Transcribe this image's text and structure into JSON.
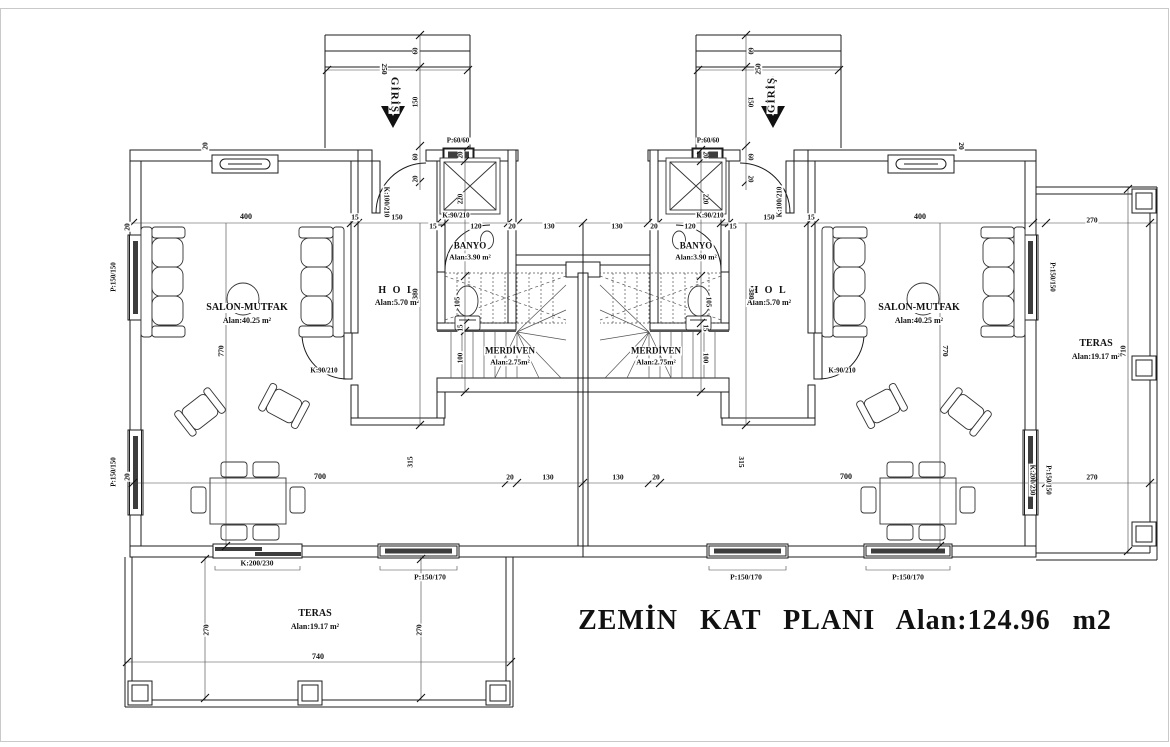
{
  "colors": {
    "line": "#1c1c1c",
    "background": "#ffffff",
    "text": "#111111"
  },
  "labels": [
    {
      "name": "room-label-salon-left",
      "text": "SALON-MUTFAK",
      "x": 247,
      "y": 308,
      "s": 10,
      "b": 1
    },
    {
      "name": "room-area-salon-left",
      "text": "Alan:40.25 m²",
      "x": 247,
      "y": 321,
      "s": 8,
      "b": 1
    },
    {
      "name": "room-label-hol-left",
      "text": "H O L",
      "x": 397,
      "y": 291,
      "s": 10,
      "b": 1,
      "ls": 2
    },
    {
      "name": "room-area-hol-left",
      "text": "Alan:5.70 m²",
      "x": 397,
      "y": 303,
      "s": 8,
      "b": 1
    },
    {
      "name": "room-label-banyo-left",
      "text": "BANYO",
      "x": 470,
      "y": 246,
      "s": 9,
      "b": 1
    },
    {
      "name": "room-area-banyo-left",
      "text": "Alan:3.90 m²",
      "x": 470,
      "y": 257,
      "s": 7.5,
      "b": 1
    },
    {
      "name": "room-label-merdiven-left",
      "text": "MERDİVEN",
      "x": 510,
      "y": 351,
      "s": 9,
      "b": 1
    },
    {
      "name": "room-area-merdiven-left",
      "text": "Alan:2.75m²",
      "x": 510,
      "y": 362,
      "s": 7.5,
      "b": 1
    },
    {
      "name": "room-label-salon-right",
      "text": "SALON-MUTFAK",
      "x": 919,
      "y": 308,
      "s": 10,
      "b": 1
    },
    {
      "name": "room-area-salon-right",
      "text": "Alan:40.25 m²",
      "x": 919,
      "y": 321,
      "s": 8,
      "b": 1
    },
    {
      "name": "room-label-hol-right",
      "text": "H O L",
      "x": 769,
      "y": 291,
      "s": 10,
      "b": 1,
      "ls": 2
    },
    {
      "name": "room-area-hol-right",
      "text": "Alan:5.70 m²",
      "x": 769,
      "y": 303,
      "s": 8,
      "b": 1
    },
    {
      "name": "room-label-banyo-right",
      "text": "BANYO",
      "x": 696,
      "y": 246,
      "s": 9,
      "b": 1
    },
    {
      "name": "room-area-banyo-right",
      "text": "Alan:3.90 m²",
      "x": 696,
      "y": 257,
      "s": 7.5,
      "b": 1
    },
    {
      "name": "room-label-merdiven-right",
      "text": "MERDİVEN",
      "x": 656,
      "y": 351,
      "s": 9,
      "b": 1
    },
    {
      "name": "room-area-merdiven-right",
      "text": "Alan:2.75m²",
      "x": 656,
      "y": 362,
      "s": 7.5,
      "b": 1
    },
    {
      "name": "room-label-teras-bottom",
      "text": "TERAS",
      "x": 315,
      "y": 614,
      "s": 10,
      "b": 1
    },
    {
      "name": "room-area-teras-bottom",
      "text": "Alan:19.17 m²",
      "x": 315,
      "y": 627,
      "s": 8,
      "b": 1
    },
    {
      "name": "room-label-teras-right",
      "text": "TERAS",
      "x": 1096,
      "y": 344,
      "s": 10,
      "b": 1
    },
    {
      "name": "room-area-teras-right",
      "text": "Alan:19.17 m²",
      "x": 1096,
      "y": 357,
      "s": 8,
      "b": 1
    },
    {
      "name": "plan-title",
      "text": "ZEMİN KAT PLANI Alan:124.96 m2",
      "x": 845,
      "y": 621,
      "s": 28,
      "b": 1,
      "ws": 14,
      "ls": 1
    },
    {
      "name": "entrance-label-left",
      "text": "GİRİŞ",
      "x": 394,
      "y": 95,
      "s": 11,
      "b": 1,
      "r": 90,
      "ls": 1
    },
    {
      "name": "entrance-label-right",
      "text": "GİRİŞ",
      "x": 772,
      "y": 95,
      "s": 11,
      "b": 1,
      "r": -90,
      "ls": 1
    },
    {
      "name": "door-code-entrance-left",
      "text": "K:100/210",
      "x": 386,
      "y": 202,
      "s": 7,
      "b": 1,
      "r": 90
    },
    {
      "name": "door-code-entrance-right",
      "text": "K:100/210",
      "x": 780,
      "y": 202,
      "s": 7,
      "b": 1,
      "r": -90
    },
    {
      "name": "door-code-banyo-left",
      "text": "K:90/210",
      "x": 456,
      "y": 216,
      "s": 7,
      "b": 1
    },
    {
      "name": "door-code-banyo-right",
      "text": "K:90/210",
      "x": 710,
      "y": 216,
      "s": 7,
      "b": 1
    },
    {
      "name": "door-code-salon-left",
      "text": "K:90/210",
      "x": 324,
      "y": 371,
      "s": 7,
      "b": 1
    },
    {
      "name": "door-code-salon-right",
      "text": "K:90/210",
      "x": 842,
      "y": 371,
      "s": 7,
      "b": 1
    },
    {
      "name": "window-code-banyo-left",
      "text": "P:60/60",
      "x": 458,
      "y": 141,
      "s": 7,
      "b": 1
    },
    {
      "name": "window-code-banyo-right",
      "text": "P:60/60",
      "x": 708,
      "y": 141,
      "s": 7,
      "b": 1
    },
    {
      "name": "window-code-left-wall-top",
      "text": "P:150/150",
      "x": 114,
      "y": 277,
      "s": 7,
      "b": 1,
      "r": -90
    },
    {
      "name": "window-code-left-wall-bottom",
      "text": "P:150/150",
      "x": 114,
      "y": 472,
      "s": 7,
      "b": 1,
      "r": -90
    },
    {
      "name": "window-code-right-wall-top",
      "text": "P:150/150",
      "x": 1052,
      "y": 277,
      "s": 7,
      "b": 1,
      "r": 90
    },
    {
      "name": "window-code-right-wall-bottom",
      "text": "P:150/150",
      "x": 1048,
      "y": 480,
      "s": 7,
      "b": 1,
      "r": 90
    },
    {
      "name": "door-code-teras-right",
      "text": "K:200/230",
      "x": 1032,
      "y": 480,
      "s": 7,
      "b": 1,
      "r": 90
    },
    {
      "name": "door-code-teras-bottom",
      "text": "K:200/230",
      "x": 257,
      "y": 563,
      "s": 7.5,
      "b": 1
    },
    {
      "name": "window-code-bottom-left",
      "text": "P:150/170",
      "x": 430,
      "y": 577,
      "s": 7.5,
      "b": 1
    },
    {
      "name": "window-code-bottom-right-1",
      "text": "P:150/170",
      "x": 746,
      "y": 577,
      "s": 7.5,
      "b": 1
    },
    {
      "name": "window-code-bottom-right-2",
      "text": "P:150/170",
      "x": 908,
      "y": 577,
      "s": 7.5,
      "b": 1
    },
    {
      "name": "dim-400-left",
      "text": "400",
      "x": 246,
      "y": 217,
      "s": 8,
      "b": 1
    },
    {
      "name": "dim-15-left-a",
      "text": "15",
      "x": 355,
      "y": 217,
      "s": 7.5,
      "b": 1
    },
    {
      "name": "dim-150-left",
      "text": "150",
      "x": 397,
      "y": 217,
      "s": 7.5,
      "b": 1
    },
    {
      "name": "dim-15-left-b",
      "text": "15",
      "x": 433,
      "y": 226,
      "s": 7.5,
      "b": 1
    },
    {
      "name": "dim-120-left",
      "text": "120",
      "x": 476,
      "y": 226,
      "s": 7.5,
      "b": 1
    },
    {
      "name": "dim-20-left-a",
      "text": "20",
      "x": 512,
      "y": 226,
      "s": 7.5,
      "b": 1
    },
    {
      "name": "dim-130-left",
      "text": "130",
      "x": 549,
      "y": 226,
      "s": 7.5,
      "b": 1
    },
    {
      "name": "dim-130-right",
      "text": "130",
      "x": 617,
      "y": 226,
      "s": 7.5,
      "b": 1
    },
    {
      "name": "dim-20-right-a",
      "text": "20",
      "x": 654,
      "y": 226,
      "s": 7.5,
      "b": 1
    },
    {
      "name": "dim-120-right",
      "text": "120",
      "x": 690,
      "y": 226,
      "s": 7.5,
      "b": 1
    },
    {
      "name": "dim-15-right-b",
      "text": "15",
      "x": 733,
      "y": 226,
      "s": 7.5,
      "b": 1
    },
    {
      "name": "dim-150-right",
      "text": "150",
      "x": 769,
      "y": 217,
      "s": 7.5,
      "b": 1
    },
    {
      "name": "dim-15-right-a",
      "text": "15",
      "x": 811,
      "y": 217,
      "s": 7.5,
      "b": 1
    },
    {
      "name": "dim-400-right",
      "text": "400",
      "x": 920,
      "y": 217,
      "s": 8,
      "b": 1
    },
    {
      "name": "dim-20-topwall-left",
      "text": "20",
      "x": 205,
      "y": 146,
      "s": 7.5,
      "b": 1,
      "r": -90
    },
    {
      "name": "dim-20-topwall-right",
      "text": "20",
      "x": 961,
      "y": 146,
      "s": 7.5,
      "b": 1,
      "r": 90
    },
    {
      "name": "dim-20-leftwall-top",
      "text": "20",
      "x": 127,
      "y": 227,
      "s": 7.5,
      "b": 1,
      "r": -90
    },
    {
      "name": "dim-20-leftwall-bottom",
      "text": "20",
      "x": 127,
      "y": 477,
      "s": 7.5,
      "b": 1,
      "r": -90
    },
    {
      "name": "dim-20-banyo-left",
      "text": "20",
      "x": 461,
      "y": 155,
      "s": 7,
      "b": 1,
      "r": -90
    },
    {
      "name": "dim-220-banyo-left",
      "text": "220",
      "x": 461,
      "y": 199,
      "s": 7,
      "b": 1,
      "r": -90
    },
    {
      "name": "dim-105-wc-left",
      "text": "105",
      "x": 458,
      "y": 302,
      "s": 7,
      "b": 1,
      "r": -90
    },
    {
      "name": "dim-15-banyo-left",
      "text": "15",
      "x": 461,
      "y": 328,
      "s": 7,
      "b": 1,
      "r": -90
    },
    {
      "name": "dim-100-stair-left",
      "text": "100",
      "x": 461,
      "y": 358,
      "s": 7,
      "b": 1,
      "r": -90
    },
    {
      "name": "dim-20-banyo-right",
      "text": "20",
      "x": 705,
      "y": 155,
      "s": 7,
      "b": 1,
      "r": 90
    },
    {
      "name": "dim-220-banyo-right",
      "text": "220",
      "x": 705,
      "y": 199,
      "s": 7,
      "b": 1,
      "r": 90
    },
    {
      "name": "dim-105-wc-right",
      "text": "105",
      "x": 708,
      "y": 302,
      "s": 7,
      "b": 1,
      "r": 90
    },
    {
      "name": "dim-15-banyo-right",
      "text": "15",
      "x": 705,
      "y": 328,
      "s": 7,
      "b": 1,
      "r": 90
    },
    {
      "name": "dim-100-stair-right",
      "text": "100",
      "x": 705,
      "y": 358,
      "s": 7,
      "b": 1,
      "r": 90
    },
    {
      "name": "dim-380-hol-left",
      "text": "380",
      "x": 415,
      "y": 294,
      "s": 7.5,
      "b": 1,
      "r": -90
    },
    {
      "name": "dim-380-hol-right",
      "text": "380",
      "x": 751,
      "y": 294,
      "s": 7.5,
      "b": 1,
      "r": 90
    },
    {
      "name": "dim-770-salon-left",
      "text": "770",
      "x": 221,
      "y": 351,
      "s": 7.5,
      "b": 1,
      "r": -90
    },
    {
      "name": "dim-770-salon-right",
      "text": "770",
      "x": 945,
      "y": 351,
      "s": 7.5,
      "b": 1,
      "r": 90
    },
    {
      "name": "dim-700-bottom-left",
      "text": "700",
      "x": 320,
      "y": 477,
      "s": 8,
      "b": 1
    },
    {
      "name": "dim-315-left",
      "text": "315",
      "x": 410,
      "y": 462,
      "s": 7.5,
      "b": 1,
      "r": -90
    },
    {
      "name": "dim-20-bottom-left",
      "text": "20",
      "x": 510,
      "y": 477,
      "s": 7.5,
      "b": 1
    },
    {
      "name": "dim-130-bottom-left",
      "text": "130",
      "x": 548,
      "y": 477,
      "s": 7.5,
      "b": 1
    },
    {
      "name": "dim-130-bottom-right",
      "text": "130",
      "x": 618,
      "y": 477,
      "s": 7.5,
      "b": 1
    },
    {
      "name": "dim-20-bottom-right",
      "text": "20",
      "x": 656,
      "y": 477,
      "s": 7.5,
      "b": 1
    },
    {
      "name": "dim-315-right",
      "text": "315",
      "x": 741,
      "y": 462,
      "s": 7.5,
      "b": 1,
      "r": 90
    },
    {
      "name": "dim-700-bottom-right",
      "text": "700",
      "x": 846,
      "y": 477,
      "s": 8,
      "b": 1
    },
    {
      "name": "dim-270-teras-bottom-left",
      "text": "270",
      "x": 206,
      "y": 630,
      "s": 7.5,
      "b": 1,
      "r": -90
    },
    {
      "name": "dim-270-teras-bottom-right",
      "text": "270",
      "x": 419,
      "y": 630,
      "s": 7.5,
      "b": 1,
      "r": -90
    },
    {
      "name": "dim-740-teras-bottom",
      "text": "740",
      "x": 318,
      "y": 657,
      "s": 8,
      "b": 1
    },
    {
      "name": "dim-270-teras-right-top",
      "text": "270",
      "x": 1092,
      "y": 220,
      "s": 7.5,
      "b": 1
    },
    {
      "name": "dim-710-teras-right",
      "text": "710",
      "x": 1123,
      "y": 351,
      "s": 7.5,
      "b": 1,
      "r": -90
    },
    {
      "name": "dim-270-teras-right-bottom",
      "text": "270",
      "x": 1092,
      "y": 477,
      "s": 7.5,
      "b": 1
    },
    {
      "name": "dim-60-porch-left-a",
      "text": "60",
      "x": 416,
      "y": 51,
      "s": 7,
      "b": 1,
      "r": -90
    },
    {
      "name": "dim-250-porch-left",
      "text": "250",
      "x": 384,
      "y": 69,
      "s": 7.5,
      "b": 1,
      "r": 90
    },
    {
      "name": "dim-150-porch-left",
      "text": "150",
      "x": 416,
      "y": 102,
      "s": 7,
      "b": 1,
      "r": -90
    },
    {
      "name": "dim-60-porch-left-b",
      "text": "60",
      "x": 416,
      "y": 157,
      "s": 7,
      "b": 1,
      "r": -90
    },
    {
      "name": "dim-20-porch-left",
      "text": "20",
      "x": 416,
      "y": 179,
      "s": 7,
      "b": 1,
      "r": -90
    },
    {
      "name": "dim-60-porch-right-a",
      "text": "60",
      "x": 750,
      "y": 51,
      "s": 7,
      "b": 1,
      "r": 90
    },
    {
      "name": "dim-250-porch-right",
      "text": "250",
      "x": 758,
      "y": 69,
      "s": 7.5,
      "b": 1,
      "r": -90
    },
    {
      "name": "dim-150-porch-right",
      "text": "150",
      "x": 750,
      "y": 102,
      "s": 7,
      "b": 1,
      "r": 90
    },
    {
      "name": "dim-60-porch-right-b",
      "text": "60",
      "x": 750,
      "y": 157,
      "s": 7,
      "b": 1,
      "r": 90
    },
    {
      "name": "dim-20-porch-right",
      "text": "20",
      "x": 750,
      "y": 179,
      "s": 7,
      "b": 1,
      "r": 90
    }
  ]
}
